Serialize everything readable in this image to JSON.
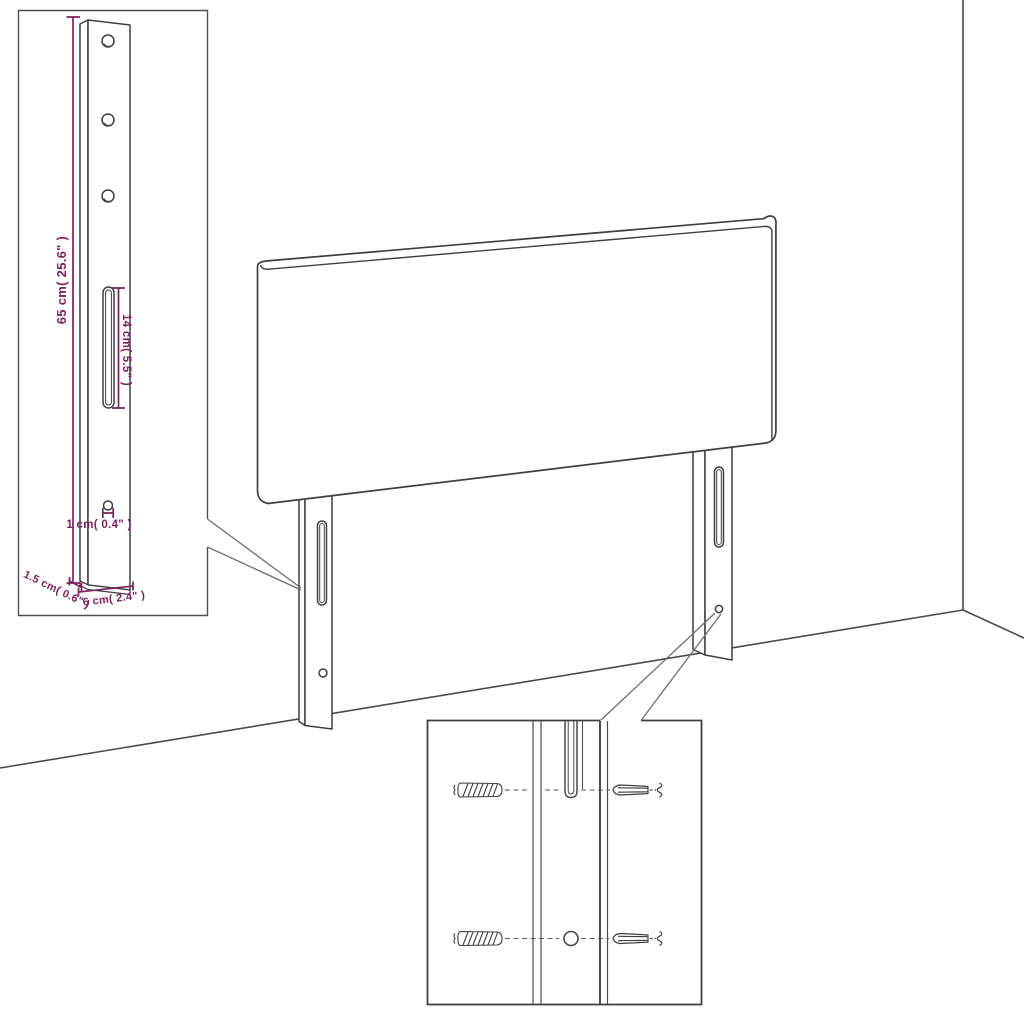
{
  "image": {
    "type": "product-dimension-diagram",
    "subject": "upholstered headboard with two wall-mount legs, leg dimension inset and mounting hardware inset",
    "background": "#ffffff"
  },
  "colors": {
    "outline": "#3f3f3f",
    "room_line": "#4a4a4a",
    "inset_border": "#4f4f4f",
    "callout_line": "#6e6e6e",
    "dimension": "#7b2360"
  },
  "leg_detail_inset": {
    "labels": {
      "height": "65 cm( 25.6\" )",
      "slot_length": "14 cm( 5.5\" )",
      "hole_diameter": "1 cm( 0.4\" )",
      "thickness": "1.5 cm( 0.6\" )",
      "width": "6 cm( 2.4\" )"
    }
  },
  "hardware_detail_inset": {
    "icons": [
      "wall-plug-icon",
      "screw-icon",
      "wall-plug-icon",
      "screw-icon"
    ]
  }
}
